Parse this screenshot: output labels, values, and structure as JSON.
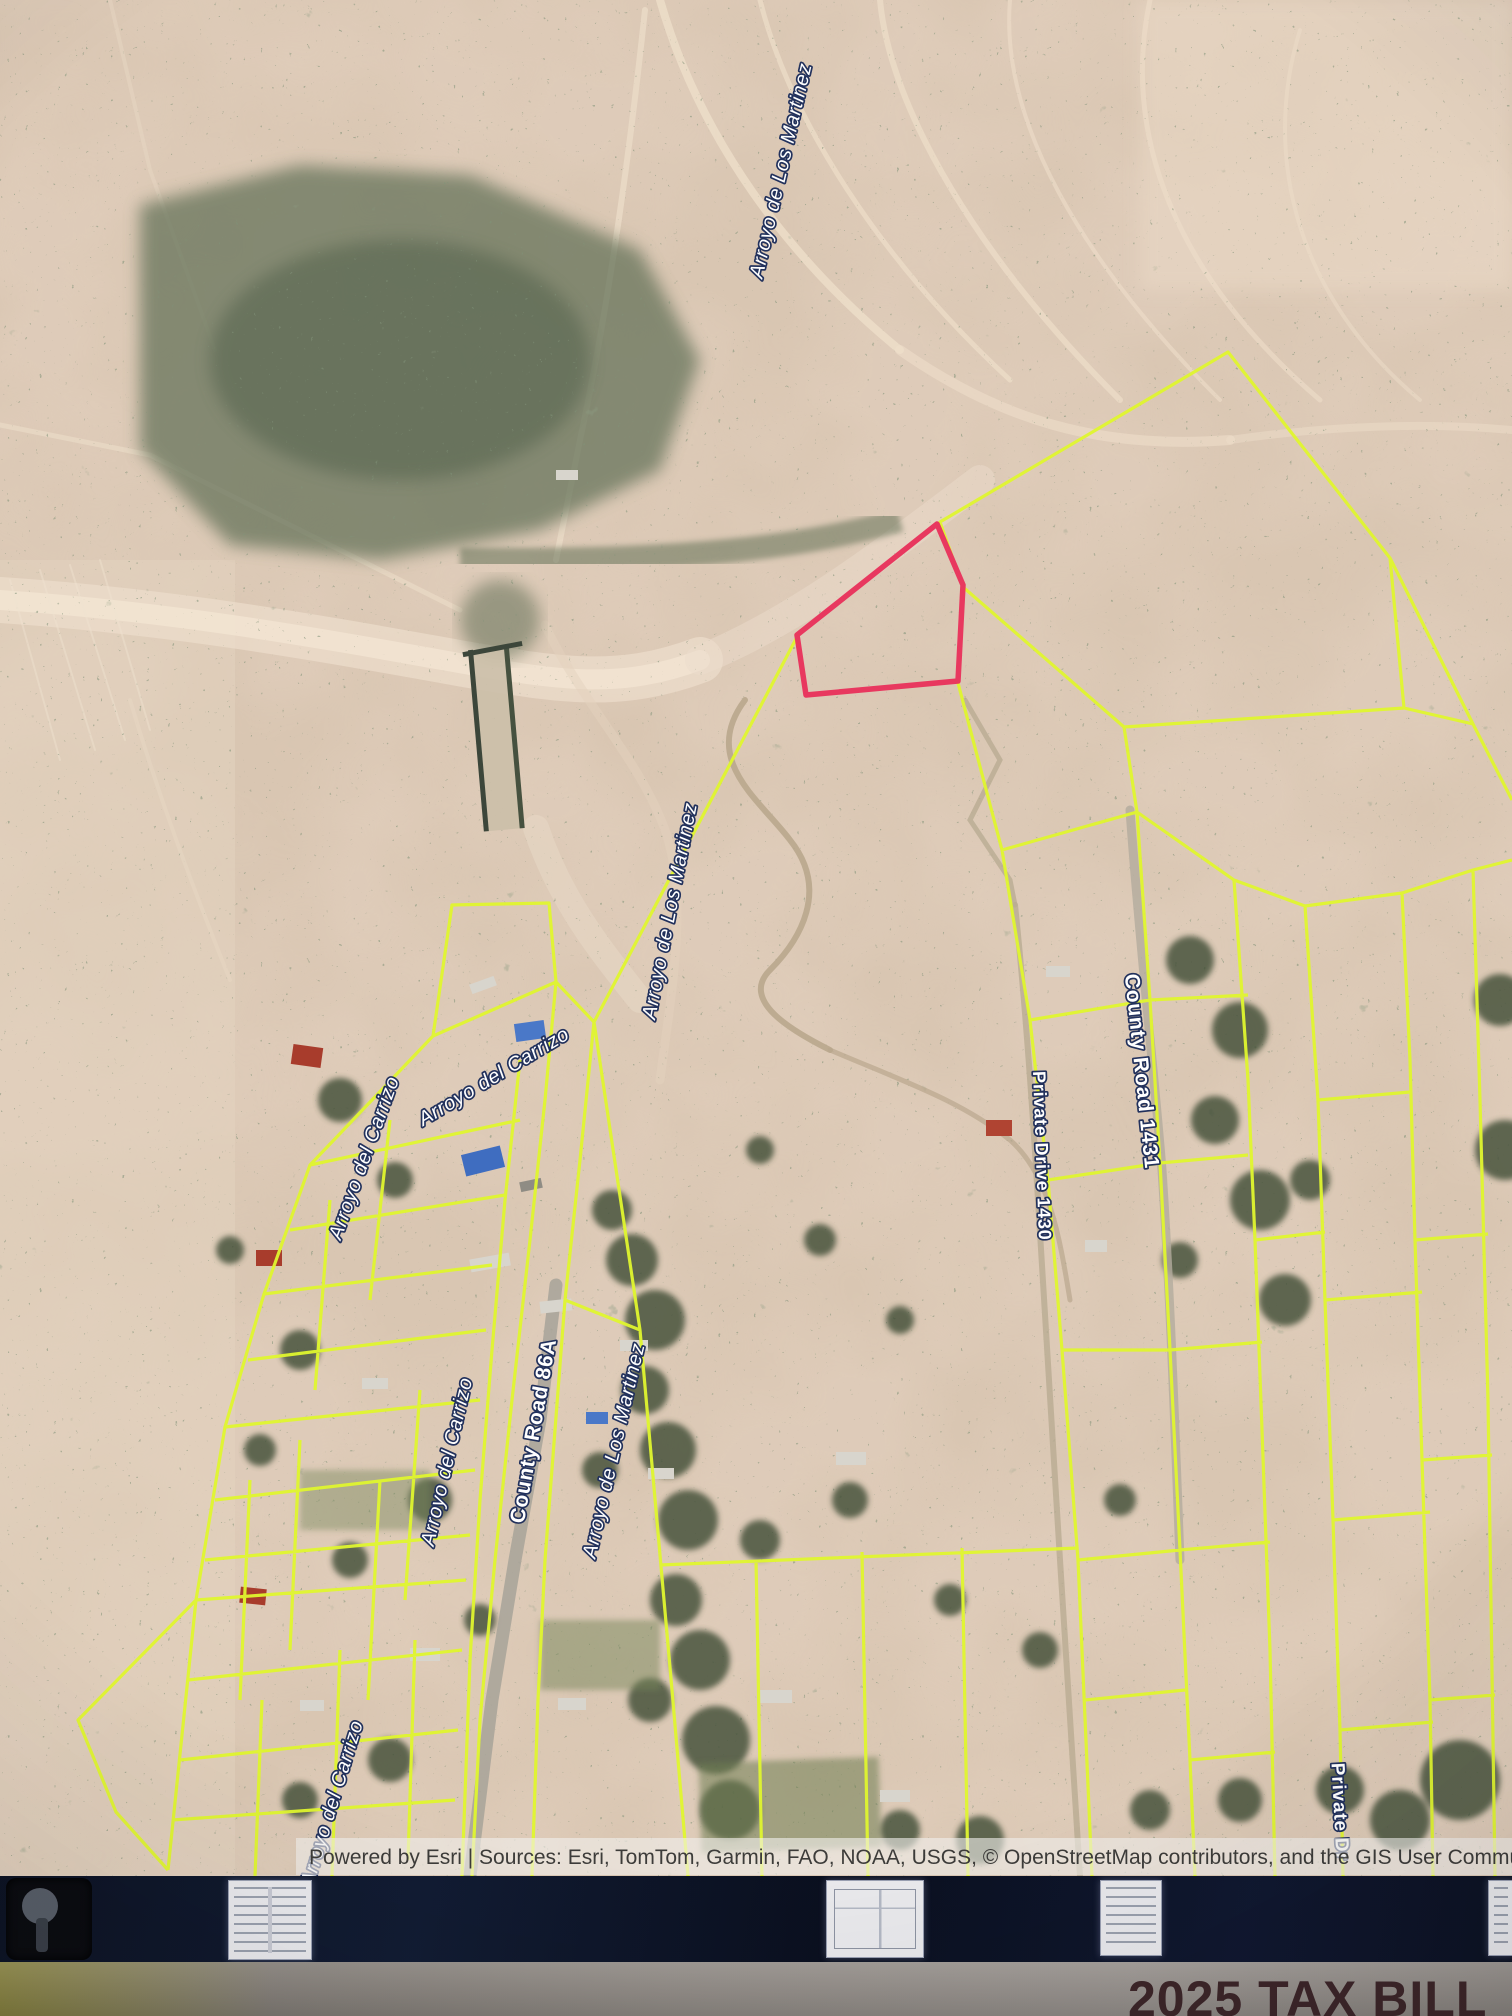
{
  "map": {
    "road_labels": {
      "county_road_86a": "County Road 86A",
      "county_road_1431": "County Road 1431",
      "private_drive_1430": "Private Drive 1430",
      "private_drive_partial": "Private Dr"
    },
    "water_labels": {
      "arroyo_martinez_top": "Arroyo de Los Martinez",
      "arroyo_martinez_mid": "Arroyo de Los Martinez",
      "arroyo_martinez_lower": "Arroyo de Los Martinez",
      "arroyo_carrizo_diagonal": "Arroyo del Carrizo",
      "arroyo_carrizo_left": "Arroyo del Carrizo",
      "arroyo_carrizo_vertical": "Arroyo del Carrizo",
      "arroyo_carrizo_bottom": "Arroyo del Carrizo"
    },
    "attribution": "Powered by Esri | Sources: Esri, TomTom, Garmin, FAO, NOAA, USGS, © OpenStreetMap contributors, and the GIS User Community",
    "colors": {
      "parcel_boundary": "#dff52e",
      "highlight_parcel": "#e8385f"
    }
  },
  "desk": {
    "tax_bill_title": "2025 TAX BILL"
  }
}
